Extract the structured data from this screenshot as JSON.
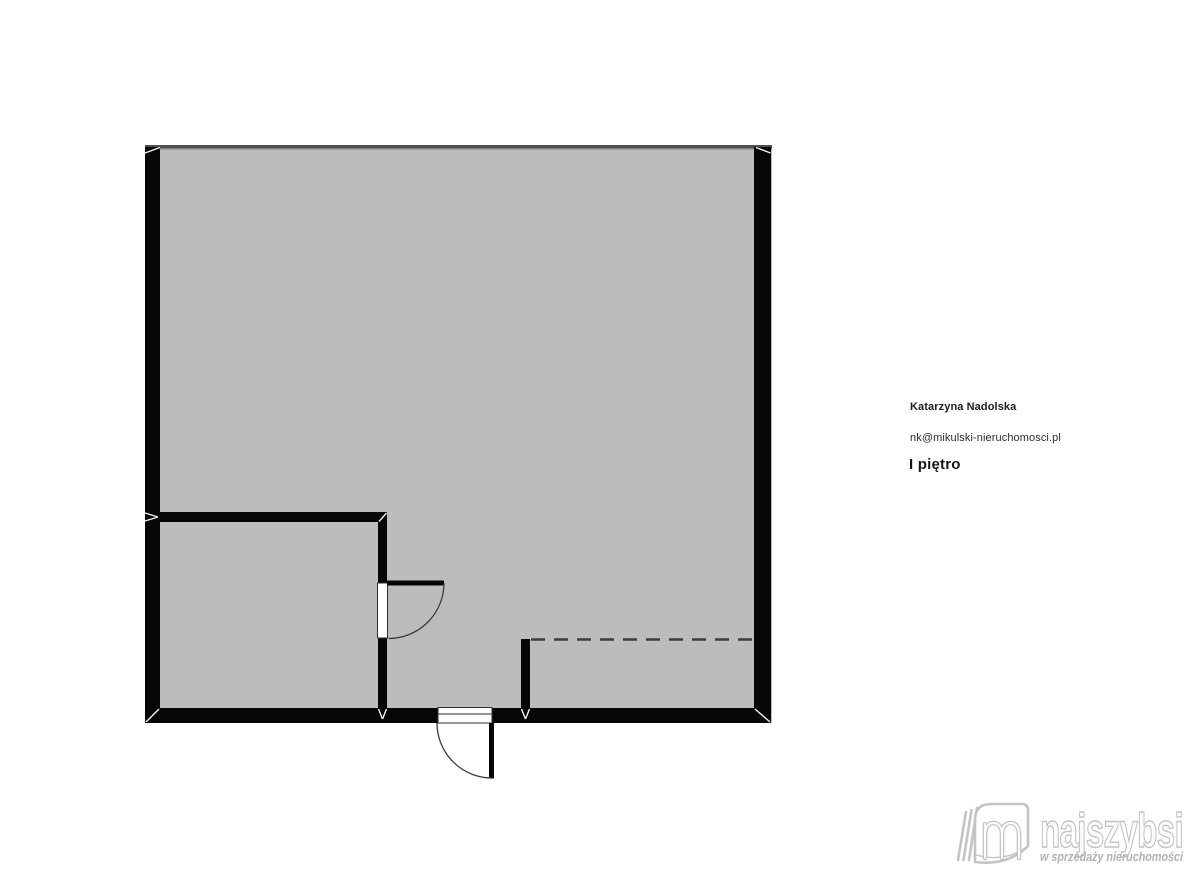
{
  "agent": {
    "name": "Katarzyna Nadolska",
    "email": "nk@mikulski-nieruchomosci.pl"
  },
  "floor_label": "I piętro",
  "logo": {
    "brand": "najszybsi",
    "tagline": "w sprzedaży nieruchomości",
    "icon": "book-m-logo-icon"
  },
  "colors": {
    "floor": "#bcbcbc",
    "wall": "#060606",
    "top-wall": "#4f4f4f",
    "dash": "#3c3c3c",
    "arc": "#3d3d3d",
    "frame-stroke": "#2f2f2f",
    "logo-line": "#c4c4c4",
    "logo-text-fill": "#fcfcfc",
    "logo-text-stroke": "#c2c2c2",
    "tagline": "#b2b2b2",
    "name-color": "#1d1d1d",
    "email-color": "#2e2e2e",
    "floor-label-color": "#161616"
  }
}
